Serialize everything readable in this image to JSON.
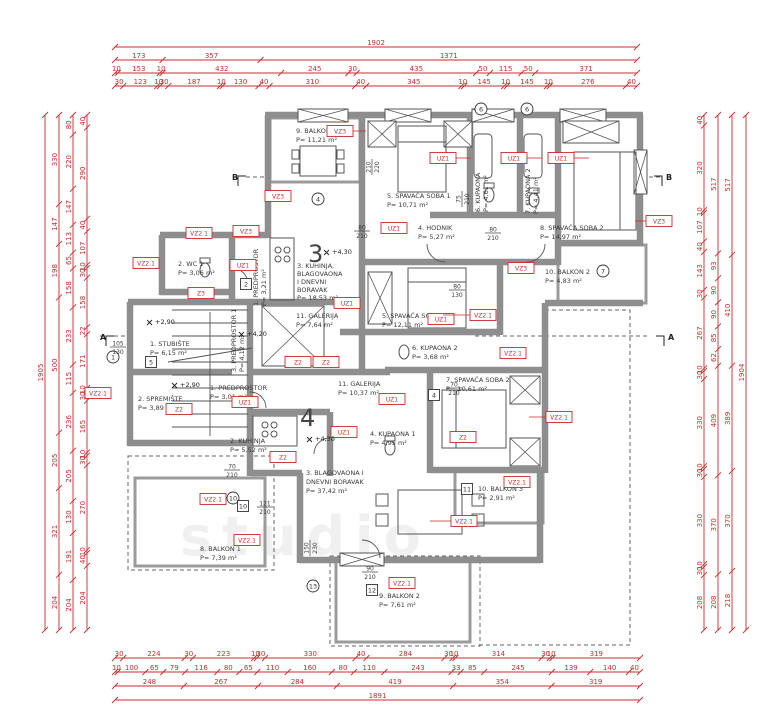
{
  "apartments": {
    "upper": "3",
    "lower": "4"
  },
  "rooms": {
    "b1a3": {
      "name": "9. BALKON 1",
      "area": "P= 11,21 m²"
    },
    "s1a3": {
      "name": "5. SPAVAĆA SOBA 1",
      "area": "P= 10,71 m²"
    },
    "k6a3": {
      "name": "6. KUPAONA",
      "area": "P= 4,61 m²"
    },
    "k7a3": {
      "name": "7. KUPAONA 2",
      "area": "P= 4,41 m²"
    },
    "s2a3": {
      "name": "8. SPAVAĆA SOBA 2",
      "area": "P= 14,97 m²"
    },
    "h4a3": {
      "name": "4. HODNIK",
      "area": "P= 5,27 m²"
    },
    "b2a3": {
      "name": "10. BALKON 2",
      "area": "P= 4,83 m²"
    },
    "wc1a3": {
      "name": "2. WC 1",
      "area": "P= 3,06 m²"
    },
    "ku3a3": {
      "l1": "3. KUHINJA,",
      "l2": "BLAGOVAONA",
      "l3": "I DNEVNI",
      "l4": "BORAVAK",
      "area": "P= 18,53 m²"
    },
    "g11a3": {
      "name": "11. GALERIJA",
      "area": "P= 7,64 m²"
    },
    "p1a3": {
      "name": "1. PREDPROSTOR",
      "area": "P= 3,21 m²"
    },
    "st1": {
      "name": "1. STUBIŠTE",
      "area": "P= 6,15 m²"
    },
    "sp2": {
      "name": "2. SPREMIŠTE",
      "area": "P= 3,89 m²"
    },
    "p3a4": {
      "name": "3. PREDPROSTOR 1",
      "area": "P= 4,12 m²"
    },
    "p1a4": {
      "name": "1. PREDPROSTOR",
      "area": "P= 3,01 m²"
    },
    "ku2a4": {
      "name": "2. KUHINJA",
      "area": "P= 5,52 m²"
    },
    "s1a4": {
      "name": "5. SPAVAĆA SOBA 1",
      "area": "P= 12,11 m²"
    },
    "k6a4": {
      "name": "6. KUPAONA 2",
      "area": "P= 3,68 m²"
    },
    "g11a4": {
      "name": "11. GALERIJA",
      "area": "P= 10,37 m²"
    },
    "s2a4": {
      "name": "7. SPAVAĆA SOBA 2",
      "area": "P= 10,61 m²"
    },
    "k4a4": {
      "name": "4. KUPAONA 1",
      "area": "P= 4,95 m²"
    },
    "bl3a4": {
      "l1": "3. BLAGOVAONA I",
      "l2": "DNEVNI BORAVAK",
      "area": "P= 37,42 m²"
    },
    "b8a4": {
      "name": "8. BALKON 1",
      "area": "P= 7,39 m²"
    },
    "b9a4": {
      "name": "9. BALKON 2",
      "area": "P= 7,61 m²"
    },
    "b10a4": {
      "name": "10. BALKON 3",
      "area": "P= 2,91 m²"
    }
  },
  "tags": [
    "VZ3",
    "VZ3",
    "VZ3",
    "UZ1",
    "UZ1",
    "UZ1",
    "VZ3",
    "UZ1",
    "VZ2.1",
    "VZ2.1",
    "UZ1",
    "VZ3",
    "Z3",
    "Z2",
    "Z2",
    "VZ2.1",
    "UZ1",
    "UZ1",
    "VZ2.1",
    "VZ2.1",
    "Z2",
    "UZ1",
    "Z2",
    "UZ1",
    "UZ1",
    "VZ2.1",
    "Z2",
    "VZ2.1",
    "VZ2.1",
    "VZ2.1",
    "VZ2.1",
    "VZ2.1"
  ],
  "markers": {
    "circles": [
      "4",
      "6",
      "6",
      "7",
      "1",
      "10",
      "13"
    ],
    "boxes": [
      "2",
      "5",
      "4",
      "10",
      "11",
      "12"
    ]
  },
  "ann": [
    {
      "w": "80",
      "h": "210"
    },
    {
      "w": "80",
      "h": "210"
    },
    {
      "w": "75",
      "h": "210"
    },
    {
      "w": "80",
      "h": "130"
    },
    {
      "w": "70",
      "h": "210"
    },
    {
      "w": "70",
      "h": "210"
    },
    {
      "w": "121",
      "h": "210"
    },
    {
      "w": "90",
      "h": "210"
    },
    {
      "w": "150",
      "h": "230"
    },
    {
      "w": "210",
      "h": "220"
    },
    {
      "w": "105",
      "h": "130"
    }
  ],
  "elevations": [
    "+4,30",
    "+4,30",
    "+2,90",
    "+2,90",
    "+4,20"
  ],
  "sections": {
    "a": "A",
    "b": "B"
  },
  "watermark": "studio",
  "colors": {
    "dimension_red": "#c92c2c",
    "wall_gray": "#8e8e8e"
  },
  "dims": {
    "top": {
      "r1": [
        1902
      ],
      "r2": [
        173,
        357,
        1371
      ],
      "r3": [
        10,
        153,
        10,
        432,
        245,
        30,
        435,
        50,
        115,
        50,
        371
      ],
      "r4": [
        30,
        123,
        10,
        30,
        187,
        10,
        130,
        40,
        310,
        40,
        345,
        10,
        145,
        10,
        145,
        10,
        276,
        40
      ]
    },
    "bottom": {
      "r1": [
        30,
        224,
        30,
        223,
        10,
        30,
        330,
        40,
        284,
        30,
        10,
        314,
        30,
        10,
        319
      ],
      "r2": [
        10,
        100,
        65,
        79,
        116,
        80,
        65,
        110,
        160,
        80,
        110,
        243,
        33,
        85,
        245,
        139,
        140,
        40
      ],
      "r3": [
        248,
        267,
        284,
        419,
        354,
        319
      ],
      "r4": [
        1891
      ]
    },
    "left": {
      "c1": [
        1905
      ],
      "c2": [
        330,
        147,
        198,
        500,
        205,
        321,
        204
      ],
      "c3": [
        80,
        220,
        147,
        113,
        65,
        158,
        233,
        115,
        236,
        205,
        130,
        191,
        204
      ],
      "c4": [
        40,
        290,
        40,
        107,
        10,
        30,
        158,
        22,
        171,
        10,
        30,
        165,
        10,
        30,
        270,
        10,
        40,
        204
      ]
    },
    "right": {
      "c1": [
        40,
        320,
        10,
        107,
        40,
        143,
        30,
        267,
        10,
        30,
        330,
        10,
        30,
        330,
        10,
        30,
        208
      ],
      "c2": [
        517,
        93,
        90,
        90,
        85,
        62,
        409,
        370,
        208
      ],
      "c3": [
        517,
        410,
        389,
        370,
        218
      ],
      "c4": [
        1904
      ]
    }
  }
}
